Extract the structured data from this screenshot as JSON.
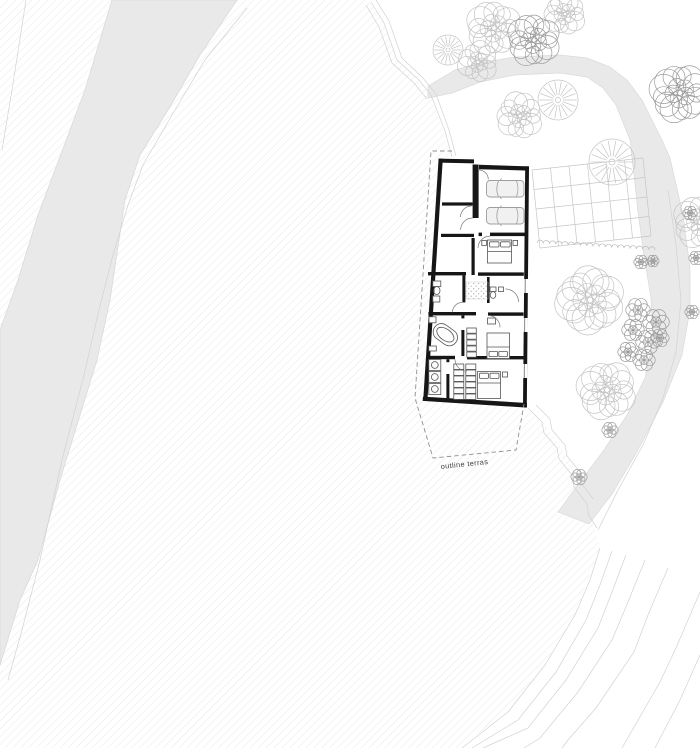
{
  "labels": {
    "terrace": "outline terras"
  },
  "colors": {
    "hatch": "#e3e3e3",
    "band": "#e9e9e9",
    "band_edge": "#dadada",
    "grid_line": "#c6c6c6",
    "hedge": "#b9b9b9",
    "contour": "#d2d2d2",
    "tree_light": "#c4c4c4",
    "tree_medium": "#9b9b9b",
    "wall": "#161616",
    "furniture": "#555555",
    "dash": "#8f8f8f",
    "label_text": "#3c3c3c"
  },
  "site": {
    "trees": [
      {
        "x": 448,
        "y": 50,
        "r": 15,
        "kind": "radial",
        "shade": "light"
      },
      {
        "x": 494,
        "y": 28,
        "r": 27,
        "kind": "scribble",
        "shade": "light"
      },
      {
        "x": 478,
        "y": 62,
        "r": 20,
        "kind": "scribble",
        "shade": "light"
      },
      {
        "x": 565,
        "y": 14,
        "r": 21,
        "kind": "scribble",
        "shade": "light"
      },
      {
        "x": 534,
        "y": 40,
        "r": 26,
        "kind": "scribble",
        "shade": "medium"
      },
      {
        "x": 558,
        "y": 100,
        "r": 20,
        "kind": "radial",
        "shade": "light"
      },
      {
        "x": 520,
        "y": 116,
        "r": 23,
        "kind": "scribble",
        "shade": "light"
      },
      {
        "x": 612,
        "y": 162,
        "r": 23,
        "kind": "radial",
        "shade": "light"
      },
      {
        "x": 680,
        "y": 93,
        "r": 29,
        "kind": "scribble",
        "shade": "medium"
      },
      {
        "x": 700,
        "y": 222,
        "r": 26,
        "kind": "scribble",
        "shade": "light"
      },
      {
        "x": 590,
        "y": 300,
        "r": 33,
        "kind": "scribble",
        "shade": "light"
      },
      {
        "x": 607,
        "y": 390,
        "r": 29,
        "kind": "scribble",
        "shade": "light"
      },
      {
        "x": 638,
        "y": 310,
        "r": 12,
        "kind": "bush",
        "shade": "medium"
      },
      {
        "x": 656,
        "y": 322,
        "r": 13,
        "kind": "bush",
        "shade": "medium"
      },
      {
        "x": 633,
        "y": 330,
        "r": 11,
        "kind": "bush",
        "shade": "medium"
      },
      {
        "x": 648,
        "y": 342,
        "r": 12,
        "kind": "bush",
        "shade": "medium"
      },
      {
        "x": 628,
        "y": 352,
        "r": 10,
        "kind": "bush",
        "shade": "medium"
      },
      {
        "x": 644,
        "y": 360,
        "r": 11,
        "kind": "bush",
        "shade": "medium"
      },
      {
        "x": 660,
        "y": 338,
        "r": 9,
        "kind": "bush",
        "shade": "medium"
      },
      {
        "x": 641,
        "y": 262,
        "r": 7,
        "kind": "bush",
        "shade": "medium"
      },
      {
        "x": 653,
        "y": 261,
        "r": 6,
        "kind": "bush",
        "shade": "medium"
      },
      {
        "x": 690,
        "y": 213,
        "r": 7,
        "kind": "bush",
        "shade": "medium"
      },
      {
        "x": 696,
        "y": 258,
        "r": 7,
        "kind": "bush",
        "shade": "medium"
      },
      {
        "x": 692,
        "y": 312,
        "r": 7,
        "kind": "bush",
        "shade": "medium"
      },
      {
        "x": 610,
        "y": 430,
        "r": 8,
        "kind": "bush",
        "shade": "medium"
      },
      {
        "x": 579,
        "y": 477,
        "r": 8,
        "kind": "bush",
        "shade": "medium"
      }
    ],
    "contours": [
      "371,2 384,23 397,60 419,80 431,95 445,131 452,157",
      "376,0 389,21 402,58 423,78 436,94 449,130 456,156",
      "366,5 379,27 392,63 414,83 427,99",
      "528,408 542,422 544,433 557,448 559,459 572,475 574,487 587,504 589,516 597,528",
      "536,405 550,419 552,430 565,445 567,456 580,472 582,484 593,499",
      "600,548 590,580 575,615 545,665 508,712 462,748",
      "612,551 600,585 586,620 556,672 518,720 472,748",
      "626,555 612,592 598,628 566,680 528,728 483,748",
      "645,560 628,602 612,640 578,692 540,738 524,748",
      "668,568 648,615 634,652 596,708 568,740 562,748",
      "700,592 676,648 660,682 622,748",
      "700,655 680,700 655,748",
      "668,190 676,245 681,300 676,352 663,398 643,445 618,490 598,530",
      "26,0 12,90 2,150",
      "247,8 205,60 172,115 143,165 128,205 113,255 99,310 84,375 62,460 40,560 22,630 8,680"
    ],
    "hatch_region": "0,0 368,0 383,20 397,60 419,79 431,95 450,155 440,160 424,400 530,409 546,426 576,470 598,540 600,548 575,615 543,666 506,712 460,748 0,748",
    "stream_band": "112,0 85,90 55,170 38,215 18,280 0,330 0,665 20,600 38,560 60,480 97,360 110,300 125,200 140,155 168,110 200,55 237,0",
    "road_band": "428,86 455,70 480,63 515,57 560,55 587,58 610,67 627,80 642,100 652,120 662,140 670,158 683,215 690,268 690,310 682,355 663,402 638,450 612,494 589,524 558,512 580,482 604,450 627,415 645,378 653,340 651,298 644,256 638,212 634,175 630,140 616,105 603,88 587,77 560,73 515,75 480,82 452,93 433,97 428,98",
    "grid": {
      "origin": [
        532,
        170
      ],
      "u": [
        111,
        -12
      ],
      "v": [
        8,
        78
      ],
      "cols": 6,
      "rows": 4
    },
    "hedge": {
      "from": [
        537,
        243
      ],
      "to": [
        655,
        250
      ],
      "bumps": 19
    },
    "terrace_outline": "452,151 431,151 415,398 433,458 516,450 524,404",
    "terrace_label_pos": {
      "x": 441,
      "y": 469,
      "rotate": -6
    }
  }
}
